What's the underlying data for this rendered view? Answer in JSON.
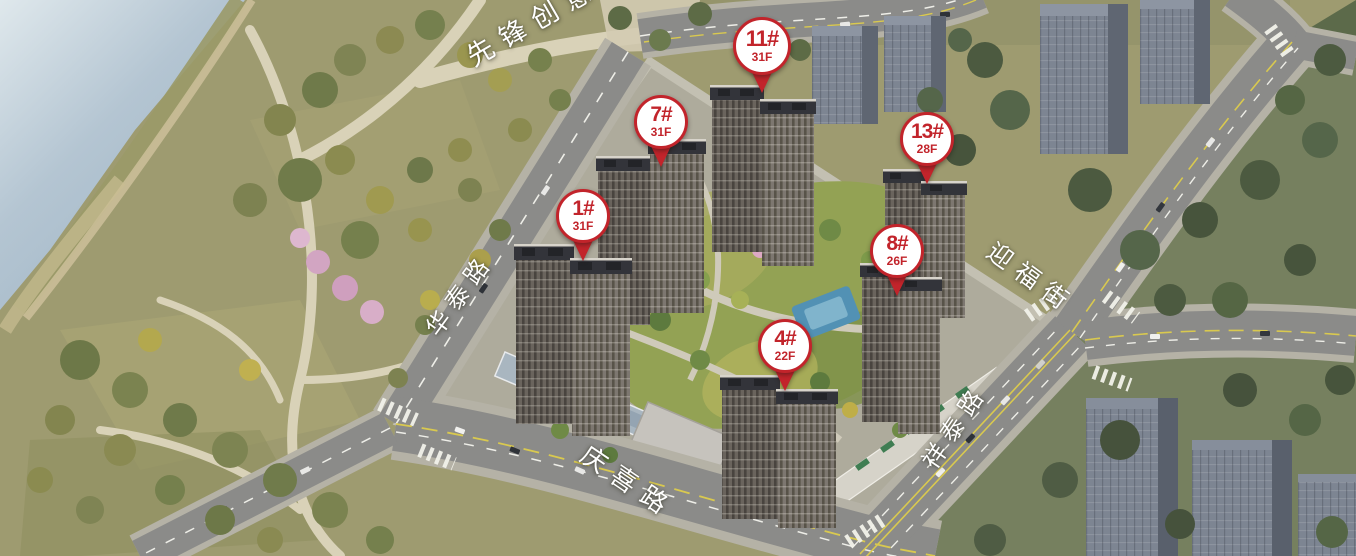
{
  "pins": [
    {
      "label": "1#",
      "floors": "31F"
    },
    {
      "label": "4#",
      "floors": "22F"
    },
    {
      "label": "7#",
      "floors": "31F"
    },
    {
      "label": "8#",
      "floors": "26F"
    },
    {
      "label": "11#",
      "floors": "31F"
    },
    {
      "label": "13#",
      "floors": "28F"
    }
  ],
  "road_labels": [
    {
      "name": "先锋创意"
    },
    {
      "name": "华泰路"
    },
    {
      "name": "迎福街"
    },
    {
      "name": "祥泰路"
    },
    {
      "name": "庆喜路"
    }
  ],
  "colors": {
    "pin_red": "#c2242b",
    "pin_white": "#ffffff",
    "road_text": "#ffffff",
    "water": "#a9bfcf",
    "park_green": "#9e9b70",
    "road_gray": "#8b8b89",
    "context_building": "#7d8592",
    "tower_facade": "#6a645d",
    "pool_blue": "#5291b4"
  }
}
